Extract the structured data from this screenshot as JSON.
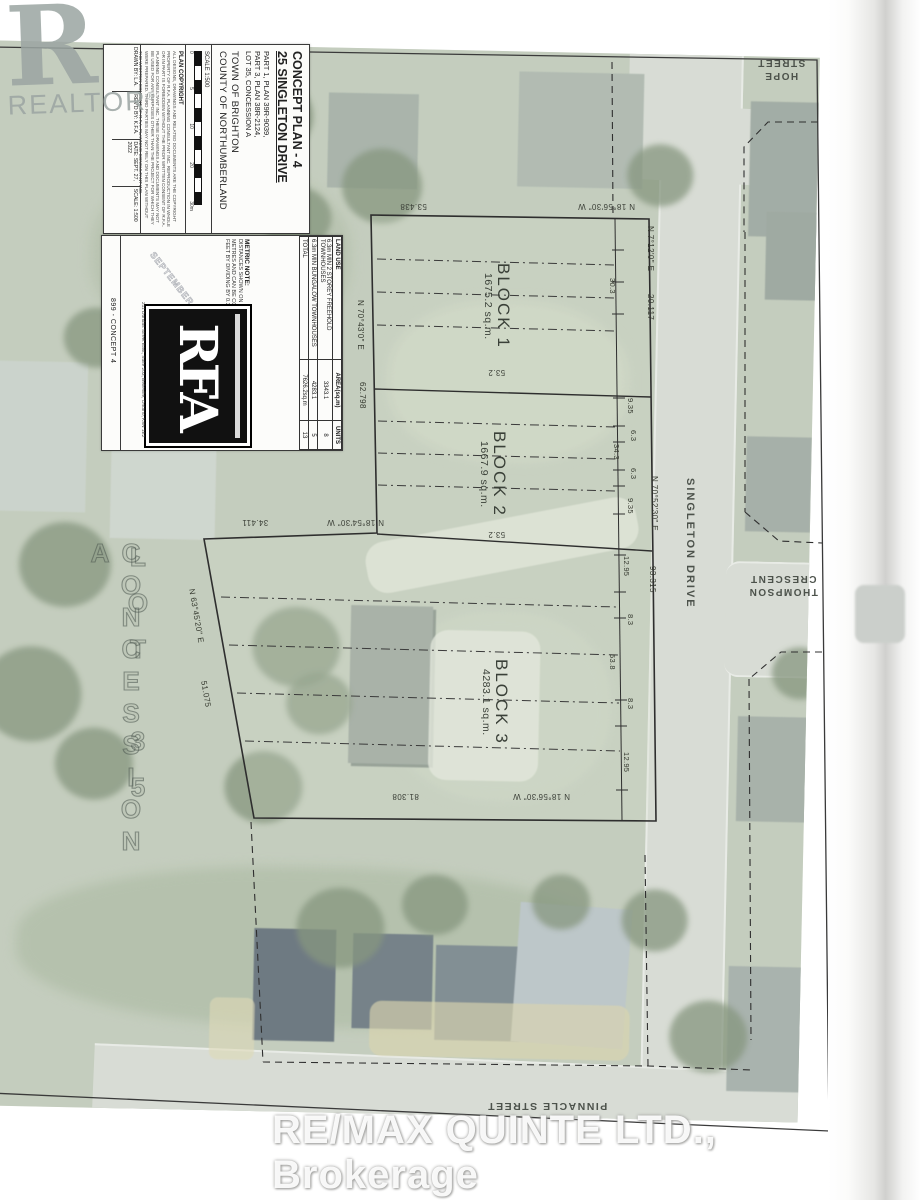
{
  "watermark": {
    "realtor_r": "R",
    "realtor": "REALTOR",
    "reg": "®",
    "brokerage": "RE/MAX QUINTE LTD.,  Brokerage"
  },
  "title_block": {
    "title": "CONCEPT PLAN - 4",
    "address": "25 SINGLETON DRIVE",
    "part_a": "PART 1, PLAN 39R-9039,",
    "part_b": "PART 3, PLAN 38R-2124,",
    "part_c": "LOT 35, CONCESSION A",
    "town": "TOWN OF BRIGHTON",
    "county": "COUNTY OF NORTHUMBERLAND",
    "scale": "SCALE 1:500",
    "scale_ticks": [
      "0",
      "5",
      "10",
      "20",
      "30m"
    ],
    "copyright_heading": "PLAN COPYRIGHT",
    "copyright_body": "All designs, drawings and related documents are the copyright property of R.F.A. Planning Consultant Inc. Reproduction in whole or in part is forbidden without the prior written consent of R.F.A. Planning Consultant Inc. These drawings and documents may not be used for any purposes other than the project for which they were prepared. Third parties may not rely on this plan without the written consent of R.F.A. Planning Consultant Inc.",
    "rev_cells": [
      "DRAWN BY: L.A.",
      "REV'D BY: K.F.A.",
      "DATE: SEPT. 27, 2022",
      "SCALE: 1:500"
    ]
  },
  "panel": {
    "land_use_header": [
      "LAND USE",
      "AREA(sq.m)",
      "UNITS"
    ],
    "rows": [
      {
        "use": "6.3m MIN 2 STOREY FREEHOLD TOWNHOUSES",
        "area": "3343.1",
        "units": "8"
      },
      {
        "use": "6.3m MIN BUNGALOW TOWNHOUSES",
        "area": "4283.1",
        "units": "5"
      },
      {
        "use": "TOTAL",
        "area": "7626.2sq.m",
        "units": "13"
      }
    ],
    "metric_heading": "METRIC NOTE:",
    "metric_body": "DISTANCES SHOWN ON THIS PLAN ARE IN METRES AND CAN BE CONVERTED TO FEET BY DIVIDING BY 0.3048.",
    "stamp": "SEPTEMBER 27 2022",
    "project_no": "899 - CONCEPT 4",
    "rfa_logo": "RFA",
    "rfa_address": "211 Dundas Street East, Suite 203, Belleville, Ontario, K8N 1E2"
  },
  "plan": {
    "block1": {
      "name": "BLOCK 1",
      "area": "1675.2 sq.m."
    },
    "block2": {
      "name": "BLOCK 2",
      "area": "1667.9 sq.m."
    },
    "block3": {
      "name": "BLOCK 3",
      "area": "4283.1 sq.m."
    },
    "bearing_top": "N 18°56'30\" W",
    "len_top": "53.438",
    "bearing_right": "N 7°12'0\" E",
    "len_right": "20.117",
    "bearing_east": "N 70°52'30\" E",
    "len_east": "93.315",
    "bearing_left": "N 70°43'0\" E",
    "len_left": "62.798",
    "bearing_mid": "N 18°54'30\" W",
    "len_mid": "34.411",
    "bearing_diag": "N 63°45'20\" E",
    "len_diag": "51.075",
    "bearing_bottom": "N 18°56'30\" W",
    "len_bottom": "81.308",
    "dim_53_2": "53.2",
    "dim_30_3": "30.3",
    "b2_dims": [
      "9.35",
      "6.3",
      "34.3",
      "6.3",
      "9.35"
    ],
    "b3_dims": [
      "12.95",
      "8.3",
      "53.8",
      "8.3",
      "12.95"
    ],
    "lot_line1": "LOT 35",
    "lot_line2": "CONCESSION A"
  },
  "streets": {
    "hope": "HOPE STREET",
    "singleton": "SINGLETON DRIVE",
    "thompson": "THOMPSON CRESCENT",
    "pinnacle": "PINNACLE STREET"
  },
  "colors": {
    "photo_base": "#bcc6b4",
    "road": "#d5d9d1",
    "line": "#2e2e2e",
    "paper": "#fcfcfa"
  }
}
